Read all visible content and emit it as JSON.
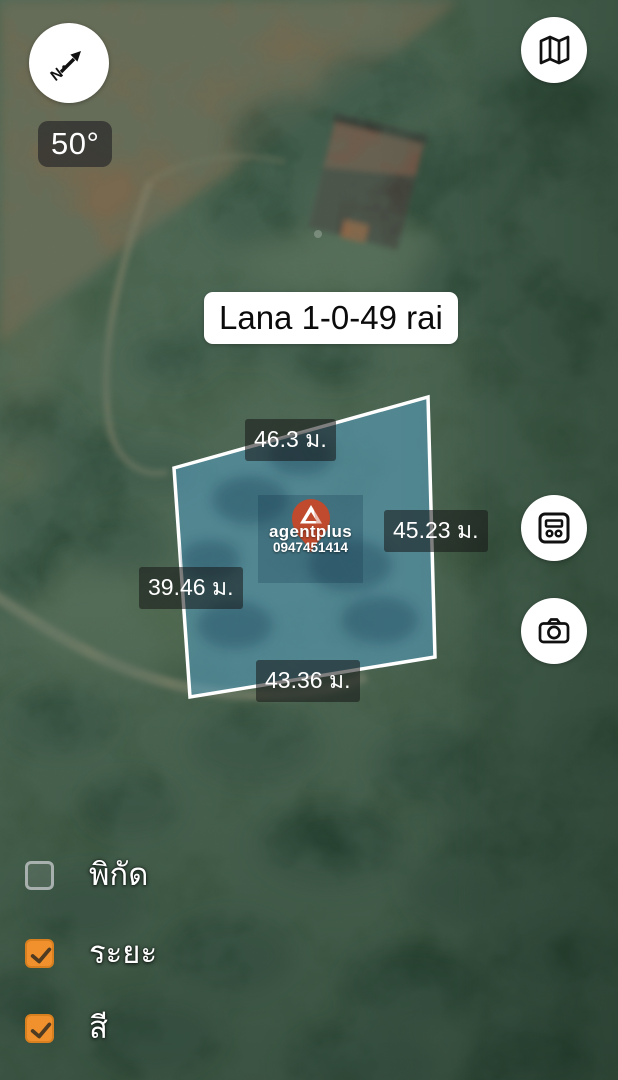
{
  "compass": {
    "bearing_label": "50°",
    "icon": "compass-north-arrow"
  },
  "toolbar": {
    "map_type_icon": "map-icon",
    "plot_info_icon": "calculator-icon",
    "camera_icon": "camera-icon"
  },
  "plot": {
    "title": "Lana 1-0-49 rai",
    "measurements": {
      "top": "46.3 ม.",
      "right": "45.23 ม.",
      "left": "39.46 ม.",
      "bottom": "43.36 ม."
    },
    "fill_color": "#57A7CF",
    "outline_color": "#FFFFFF"
  },
  "watermark": {
    "brand": "agentplus",
    "phone": "0947451414",
    "pin_color": "#BF4A2D"
  },
  "layer_toggles": [
    {
      "label": "พิกัด",
      "checked": false
    },
    {
      "label": "ระยะ",
      "checked": true
    },
    {
      "label": "สี",
      "checked": true
    }
  ],
  "colors": {
    "checkbox_orange": "#F0912D"
  }
}
